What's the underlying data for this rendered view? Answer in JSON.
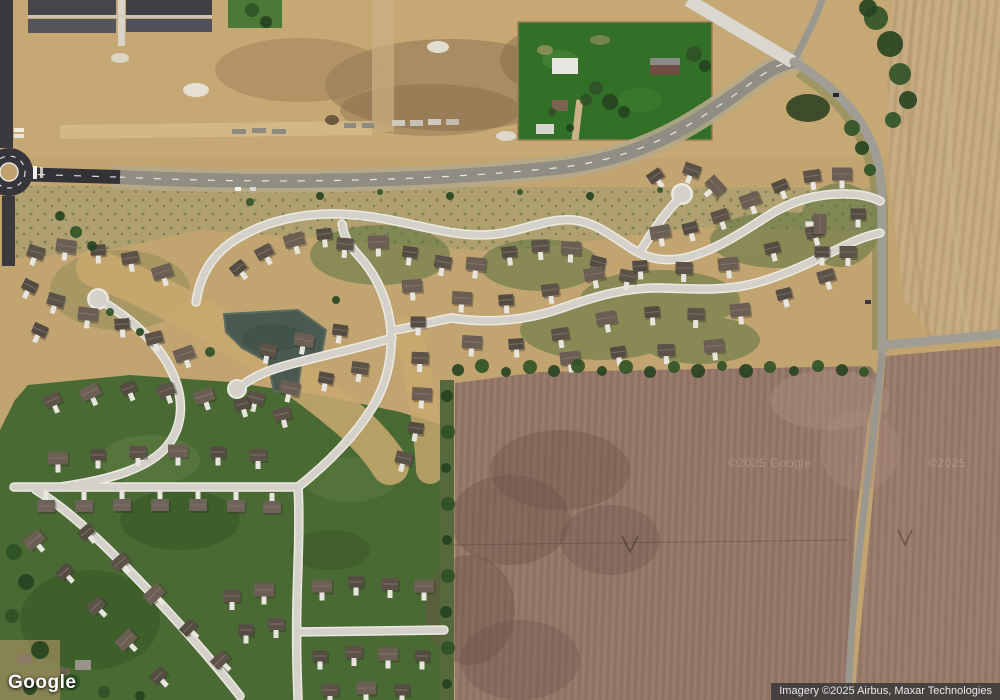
{
  "map": {
    "provider_logo": "Google",
    "attribution": "Imagery ©2025 Airbus, Maxar Technologies",
    "watermark": "©2025 Google",
    "watermark_partial": "©2025",
    "view_type": "satellite"
  },
  "colors": {
    "dirt": "#c2a471",
    "asphalt_new": "#323237",
    "asphalt_worn": "#8f8d84",
    "concrete_street": "#d3d1c9",
    "pond": "#4a5a50",
    "plowed_field": "#957769",
    "harvest_field": "#c3a97f",
    "lawn": "#4a6a34",
    "roof_dark": "#5d5248"
  },
  "features": {
    "house_variants": [
      {
        "w": 17,
        "h": 12,
        "fill": "#5d5248"
      },
      {
        "w": 20,
        "h": 13,
        "fill": "#6b5e53"
      },
      {
        "w": 15,
        "h": 11,
        "fill": "#544b42"
      },
      {
        "w": 18,
        "h": 12,
        "fill": "#6e635a"
      }
    ],
    "driveway_fill": "#e7e5dd",
    "houses": [
      [
        345,
        244,
        4
      ],
      [
        378,
        242,
        -2
      ],
      [
        410,
        252,
        8
      ],
      [
        443,
        262,
        10
      ],
      [
        476,
        264,
        5
      ],
      [
        509,
        252,
        -6
      ],
      [
        540,
        246,
        -4
      ],
      [
        571,
        248,
        3
      ],
      [
        598,
        262,
        14
      ],
      [
        628,
        276,
        10
      ],
      [
        660,
        232,
        -10
      ],
      [
        690,
        228,
        -14
      ],
      [
        720,
        216,
        -18
      ],
      [
        750,
        200,
        -20
      ],
      [
        780,
        186,
        -22
      ],
      [
        812,
        176,
        -8
      ],
      [
        842,
        174,
        0
      ],
      [
        655,
        176,
        -35
      ],
      [
        692,
        170,
        20
      ],
      [
        716,
        186,
        48
      ],
      [
        238,
        268,
        -38
      ],
      [
        264,
        252,
        -28
      ],
      [
        294,
        240,
        -16
      ],
      [
        324,
        234,
        -6
      ],
      [
        36,
        252,
        18
      ],
      [
        66,
        246,
        8
      ],
      [
        98,
        250,
        -2
      ],
      [
        130,
        258,
        -10
      ],
      [
        162,
        272,
        -18
      ],
      [
        30,
        286,
        26
      ],
      [
        56,
        300,
        16
      ],
      [
        88,
        314,
        6
      ],
      [
        122,
        324,
        -4
      ],
      [
        154,
        338,
        -14
      ],
      [
        184,
        354,
        -20
      ],
      [
        40,
        330,
        24
      ],
      [
        268,
        350,
        12
      ],
      [
        304,
        340,
        10
      ],
      [
        340,
        330,
        8
      ],
      [
        256,
        398,
        14
      ],
      [
        290,
        388,
        12
      ],
      [
        326,
        378,
        10
      ],
      [
        360,
        368,
        8
      ],
      [
        412,
        286,
        -4
      ],
      [
        418,
        322,
        0
      ],
      [
        420,
        358,
        2
      ],
      [
        422,
        394,
        4
      ],
      [
        416,
        428,
        8
      ],
      [
        404,
        458,
        14
      ],
      [
        462,
        298,
        4
      ],
      [
        506,
        300,
        -4
      ],
      [
        550,
        290,
        -8
      ],
      [
        594,
        274,
        -10
      ],
      [
        640,
        266,
        -4
      ],
      [
        684,
        268,
        2
      ],
      [
        728,
        264,
        -6
      ],
      [
        772,
        248,
        -14
      ],
      [
        814,
        232,
        -16
      ],
      [
        472,
        342,
        4
      ],
      [
        516,
        344,
        -4
      ],
      [
        560,
        334,
        -8
      ],
      [
        606,
        318,
        -10
      ],
      [
        652,
        312,
        -4
      ],
      [
        696,
        314,
        2
      ],
      [
        740,
        310,
        -6
      ],
      [
        784,
        294,
        -14
      ],
      [
        826,
        276,
        -16
      ],
      [
        570,
        358,
        -6
      ],
      [
        618,
        352,
        -8
      ],
      [
        666,
        350,
        -2
      ],
      [
        714,
        346,
        -6
      ],
      [
        822,
        252,
        0
      ],
      [
        848,
        252,
        0
      ],
      [
        820,
        224,
        90
      ],
      [
        858,
        214,
        0
      ],
      [
        52,
        400,
        -24
      ],
      [
        90,
        392,
        -24
      ],
      [
        128,
        388,
        -22
      ],
      [
        166,
        390,
        -20
      ],
      [
        204,
        396,
        -18
      ],
      [
        242,
        404,
        -16
      ],
      [
        282,
        414,
        -14
      ],
      [
        58,
        458,
        0
      ],
      [
        98,
        455,
        0
      ],
      [
        138,
        452,
        0
      ],
      [
        178,
        451,
        0
      ],
      [
        218,
        452,
        0
      ],
      [
        258,
        455,
        0
      ],
      [
        46,
        506,
        0,
        3
      ],
      [
        84,
        506,
        0,
        3
      ],
      [
        122,
        505,
        0,
        3
      ],
      [
        160,
        505,
        0,
        3
      ],
      [
        198,
        505,
        0,
        3
      ],
      [
        236,
        506,
        0,
        3
      ],
      [
        272,
        507,
        0,
        3
      ],
      [
        86,
        532,
        -40
      ],
      [
        120,
        562,
        -42
      ],
      [
        154,
        594,
        -44
      ],
      [
        188,
        628,
        -46
      ],
      [
        220,
        660,
        -44
      ],
      [
        34,
        540,
        -40
      ],
      [
        64,
        572,
        -42
      ],
      [
        96,
        606,
        -44
      ],
      [
        126,
        640,
        -44
      ],
      [
        158,
        676,
        -42
      ],
      [
        232,
        596,
        0
      ],
      [
        264,
        590,
        0
      ],
      [
        246,
        630,
        0
      ],
      [
        276,
        624,
        0
      ],
      [
        322,
        586,
        0
      ],
      [
        356,
        582,
        0
      ],
      [
        390,
        584,
        0
      ],
      [
        424,
        586,
        0
      ],
      [
        320,
        656,
        0
      ],
      [
        354,
        652,
        0
      ],
      [
        388,
        654,
        0
      ],
      [
        422,
        656,
        0
      ],
      [
        330,
        690,
        0
      ],
      [
        366,
        688,
        0
      ],
      [
        402,
        690,
        0
      ]
    ],
    "trees": [
      [
        596,
        88,
        7
      ],
      [
        610,
        102,
        8
      ],
      [
        586,
        100,
        6
      ],
      [
        624,
        112,
        6
      ],
      [
        694,
        54,
        8
      ],
      [
        705,
        66,
        6
      ],
      [
        552,
        112,
        4
      ],
      [
        570,
        128,
        4
      ],
      [
        876,
        18,
        12
      ],
      [
        890,
        44,
        13
      ],
      [
        900,
        74,
        11
      ],
      [
        908,
        100,
        9
      ],
      [
        893,
        120,
        8
      ],
      [
        868,
        8,
        9
      ],
      [
        852,
        128,
        8
      ],
      [
        862,
        148,
        7
      ],
      [
        870,
        170,
        6
      ],
      [
        458,
        370,
        6
      ],
      [
        482,
        366,
        7
      ],
      [
        506,
        372,
        5
      ],
      [
        530,
        367,
        7
      ],
      [
        554,
        371,
        6
      ],
      [
        578,
        366,
        7
      ],
      [
        602,
        371,
        5
      ],
      [
        626,
        367,
        7
      ],
      [
        650,
        372,
        6
      ],
      [
        674,
        367,
        6
      ],
      [
        698,
        371,
        7
      ],
      [
        722,
        366,
        5
      ],
      [
        746,
        371,
        7
      ],
      [
        770,
        367,
        6
      ],
      [
        794,
        371,
        5
      ],
      [
        818,
        366,
        6
      ],
      [
        842,
        370,
        6
      ],
      [
        864,
        372,
        5
      ],
      [
        447,
        396,
        6
      ],
      [
        448,
        432,
        7
      ],
      [
        446,
        468,
        5
      ],
      [
        448,
        504,
        7
      ],
      [
        447,
        540,
        5
      ],
      [
        448,
        576,
        7
      ],
      [
        446,
        612,
        6
      ],
      [
        448,
        648,
        7
      ],
      [
        447,
        684,
        5
      ],
      [
        14,
        552,
        8
      ],
      [
        26,
        582,
        8
      ],
      [
        12,
        616,
        7
      ],
      [
        40,
        650,
        9
      ],
      [
        72,
        682,
        8
      ],
      [
        30,
        688,
        7
      ],
      [
        104,
        692,
        6
      ],
      [
        140,
        696,
        5
      ],
      [
        250,
        202,
        4
      ],
      [
        320,
        196,
        4
      ],
      [
        380,
        192,
        3
      ],
      [
        450,
        196,
        4
      ],
      [
        520,
        192,
        3
      ],
      [
        590,
        196,
        4
      ],
      [
        660,
        190,
        3
      ],
      [
        60,
        216,
        5
      ],
      [
        76,
        232,
        6
      ],
      [
        92,
        246,
        5
      ],
      [
        110,
        312,
        4
      ],
      [
        140,
        332,
        4
      ],
      [
        210,
        352,
        5
      ],
      [
        336,
        300,
        4
      ],
      [
        252,
        10,
        7
      ],
      [
        266,
        22,
        6
      ]
    ],
    "vehicles": [
      [
        238,
        189,
        "#f5f5f2"
      ],
      [
        253,
        189,
        "#d8d8d2"
      ],
      [
        836,
        95,
        "#26262a"
      ],
      [
        868,
        302,
        "#3a3a40"
      ]
    ]
  }
}
